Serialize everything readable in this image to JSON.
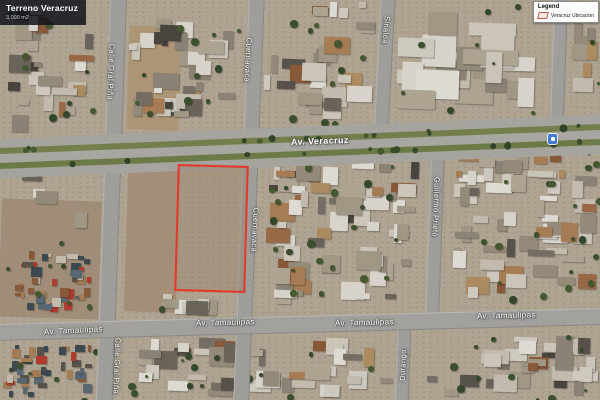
{
  "title_overlay": {
    "title": "Terreno Veracruz",
    "area": "3,000 m2"
  },
  "legend": {
    "title": "Legend",
    "items": [
      {
        "label": "Veracruz Ubicacion",
        "symbol": "parcel-outline",
        "symbol_color": "#b5473a"
      }
    ]
  },
  "streets": {
    "veracruz": "Av. Veracruz",
    "tamaulipas": "Av. Tamaulipas",
    "gral_pina": "Calle Gral Piña",
    "cuernavaca": "Cuernavaca",
    "sinaloa": "Sinaloa",
    "guillermo_prieto": "Guillermo Prieto",
    "durango": "Durango"
  },
  "parcel": {
    "outline_color": "#e8392a"
  },
  "icons": {
    "poi": "transit-stop-icon"
  },
  "map": {
    "view": "satellite"
  }
}
